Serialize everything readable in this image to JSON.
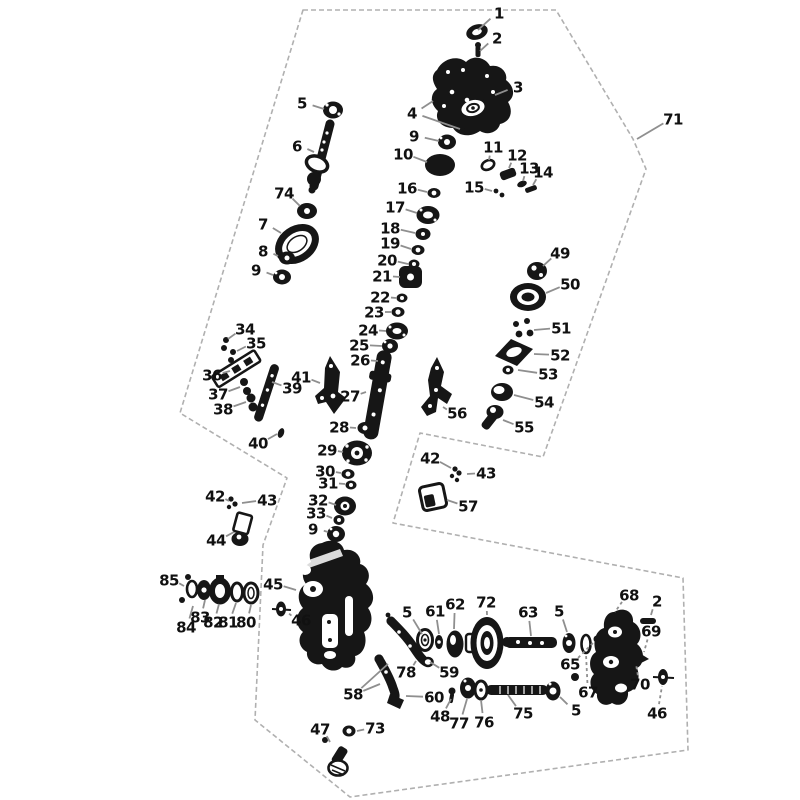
{
  "diagram": {
    "type": "exploded-parts-diagram",
    "title": "Gearbox / transfer case exploded parts diagram",
    "background_color": "#ffffff",
    "ink_color": "#161616",
    "leader_color": "#8f8f8f",
    "outline_color": "#b0b0b0",
    "canvas": {
      "width": 800,
      "height": 800
    },
    "outline_label": "71",
    "outline_points": [
      [
        303,
        10
      ],
      [
        556,
        10
      ],
      [
        633,
        139
      ],
      [
        646,
        169
      ],
      [
        543,
        457
      ],
      [
        420,
        433
      ],
      [
        393,
        523
      ],
      [
        683,
        578
      ],
      [
        688,
        750
      ],
      [
        350,
        797
      ],
      [
        255,
        720
      ],
      [
        263,
        545
      ],
      [
        287,
        478
      ],
      [
        180,
        413
      ]
    ],
    "callouts": [
      {
        "n": "1",
        "x": 499,
        "y": 13,
        "leads": [
          [
            478,
            30
          ]
        ]
      },
      {
        "n": "2",
        "x": 497,
        "y": 38,
        "leads": [
          [
            480,
            51
          ]
        ]
      },
      {
        "n": "3",
        "x": 518,
        "y": 87,
        "leads": [
          [
            495,
            95
          ]
        ]
      },
      {
        "n": "4",
        "x": 412,
        "y": 113,
        "leads": [
          [
            433,
            101
          ],
          [
            460,
            129
          ]
        ]
      },
      {
        "n": "5",
        "x": 302,
        "y": 103,
        "leads": [
          [
            324,
            109
          ]
        ]
      },
      {
        "n": "6",
        "x": 297,
        "y": 146,
        "leads": [
          [
            314,
            152
          ]
        ]
      },
      {
        "n": "9",
        "x": 414,
        "y": 136,
        "leads": [
          [
            439,
            141
          ]
        ]
      },
      {
        "n": "10",
        "x": 403,
        "y": 154,
        "leads": [
          [
            427,
            162
          ]
        ]
      },
      {
        "n": "11",
        "x": 493,
        "y": 147,
        "leads": [
          [
            489,
            160
          ]
        ]
      },
      {
        "n": "12",
        "x": 517,
        "y": 155,
        "leads": [
          [
            509,
            168
          ]
        ]
      },
      {
        "n": "13",
        "x": 529,
        "y": 168,
        "leads": [
          [
            523,
            181
          ]
        ]
      },
      {
        "n": "14",
        "x": 543,
        "y": 172,
        "leads": [
          [
            533,
            185
          ]
        ]
      },
      {
        "n": "15",
        "x": 474,
        "y": 187,
        "leads": [
          [
            492,
            191
          ]
        ]
      },
      {
        "n": "16",
        "x": 407,
        "y": 188,
        "leads": [
          [
            427,
            192
          ]
        ]
      },
      {
        "n": "74",
        "x": 284,
        "y": 193,
        "leads": [
          [
            300,
            206
          ]
        ]
      },
      {
        "n": "7",
        "x": 263,
        "y": 224,
        "leads": [
          [
            281,
            233
          ]
        ]
      },
      {
        "n": "8",
        "x": 263,
        "y": 251,
        "leads": [
          [
            278,
            256
          ]
        ]
      },
      {
        "n": "9",
        "x": 256,
        "y": 270,
        "leads": [
          [
            273,
            275
          ]
        ]
      },
      {
        "n": "17",
        "x": 395,
        "y": 207,
        "leads": [
          [
            417,
            213
          ]
        ]
      },
      {
        "n": "18",
        "x": 390,
        "y": 228,
        "leads": [
          [
            415,
            233
          ]
        ]
      },
      {
        "n": "19",
        "x": 390,
        "y": 243,
        "leads": [
          [
            411,
            249
          ]
        ]
      },
      {
        "n": "20",
        "x": 387,
        "y": 260,
        "leads": [
          [
            408,
            264
          ]
        ]
      },
      {
        "n": "21",
        "x": 382,
        "y": 276,
        "leads": [
          [
            400,
            277
          ]
        ]
      },
      {
        "n": "22",
        "x": 380,
        "y": 297,
        "leads": [
          [
            396,
            298
          ]
        ]
      },
      {
        "n": "23",
        "x": 374,
        "y": 312,
        "leads": [
          [
            391,
            312
          ]
        ]
      },
      {
        "n": "24",
        "x": 368,
        "y": 330,
        "leads": [
          [
            386,
            331
          ]
        ]
      },
      {
        "n": "25",
        "x": 359,
        "y": 345,
        "leads": [
          [
            382,
            346
          ]
        ]
      },
      {
        "n": "26",
        "x": 360,
        "y": 360,
        "leads": [
          [
            378,
            361
          ]
        ]
      },
      {
        "n": "49",
        "x": 560,
        "y": 253,
        "leads": [
          [
            543,
            266
          ]
        ]
      },
      {
        "n": "50",
        "x": 570,
        "y": 284,
        "leads": [
          [
            546,
            293
          ]
        ]
      },
      {
        "n": "51",
        "x": 561,
        "y": 328,
        "leads": [
          [
            534,
            330
          ]
        ]
      },
      {
        "n": "52",
        "x": 560,
        "y": 355,
        "leads": [
          [
            534,
            354
          ]
        ]
      },
      {
        "n": "53",
        "x": 548,
        "y": 374,
        "leads": [
          [
            518,
            370
          ]
        ]
      },
      {
        "n": "54",
        "x": 544,
        "y": 402,
        "leads": [
          [
            514,
            395
          ]
        ]
      },
      {
        "n": "55",
        "x": 524,
        "y": 427,
        "leads": [
          [
            503,
            420
          ]
        ]
      },
      {
        "n": "56",
        "x": 457,
        "y": 413,
        "leads": [
          [
            443,
            407
          ]
        ]
      },
      {
        "n": "34",
        "x": 245,
        "y": 329,
        "leads": [
          [
            228,
            339
          ]
        ]
      },
      {
        "n": "35",
        "x": 256,
        "y": 343,
        "leads": [
          [
            237,
            351
          ]
        ]
      },
      {
        "n": "36",
        "x": 212,
        "y": 375,
        "leads": [
          [
            230,
            371
          ]
        ]
      },
      {
        "n": "37",
        "x": 218,
        "y": 394,
        "leads": [
          [
            240,
            387
          ]
        ]
      },
      {
        "n": "38",
        "x": 223,
        "y": 409,
        "leads": [
          [
            246,
            402
          ]
        ]
      },
      {
        "n": "39",
        "x": 292,
        "y": 388,
        "leads": [
          [
            272,
            382
          ]
        ]
      },
      {
        "n": "40",
        "x": 258,
        "y": 443,
        "leads": [
          [
            277,
            434
          ]
        ]
      },
      {
        "n": "41",
        "x": 301,
        "y": 377,
        "leads": [
          [
            320,
            383
          ]
        ]
      },
      {
        "n": "27",
        "x": 350,
        "y": 396,
        "leads": [
          [
            366,
            392
          ]
        ]
      },
      {
        "n": "28",
        "x": 339,
        "y": 427,
        "leads": [
          [
            356,
            428
          ]
        ]
      },
      {
        "n": "29",
        "x": 327,
        "y": 450,
        "leads": [
          [
            343,
            452
          ]
        ]
      },
      {
        "n": "30",
        "x": 325,
        "y": 471,
        "leads": [
          [
            341,
            473
          ]
        ]
      },
      {
        "n": "31",
        "x": 328,
        "y": 483,
        "leads": [
          [
            345,
            484
          ]
        ]
      },
      {
        "n": "32",
        "x": 318,
        "y": 500,
        "leads": [
          [
            336,
            505
          ]
        ]
      },
      {
        "n": "33",
        "x": 316,
        "y": 513,
        "leads": [
          [
            332,
            518
          ]
        ]
      },
      {
        "n": "9",
        "x": 313,
        "y": 529,
        "leads": [
          [
            328,
            532
          ]
        ]
      },
      {
        "n": "42",
        "x": 215,
        "y": 496,
        "leads": [
          [
            229,
            501
          ]
        ]
      },
      {
        "n": "43",
        "x": 267,
        "y": 500,
        "leads": [
          [
            242,
            503
          ]
        ]
      },
      {
        "n": "44",
        "x": 216,
        "y": 540,
        "leads": [
          [
            234,
            532
          ]
        ]
      },
      {
        "n": "42",
        "x": 430,
        "y": 458,
        "leads": [
          [
            451,
            468
          ]
        ]
      },
      {
        "n": "43",
        "x": 486,
        "y": 473,
        "leads": [
          [
            467,
            474
          ]
        ]
      },
      {
        "n": "57",
        "x": 468,
        "y": 506,
        "leads": [
          [
            447,
            500
          ]
        ]
      },
      {
        "n": "45",
        "x": 273,
        "y": 584,
        "leads": [
          [
            296,
            590
          ]
        ]
      },
      {
        "n": "46",
        "x": 301,
        "y": 620,
        "dash": true,
        "leads": [
          [
            287,
            612
          ]
        ]
      },
      {
        "n": "85",
        "x": 169,
        "y": 580,
        "leads": [
          [
            184,
            586
          ]
        ]
      },
      {
        "n": "83",
        "x": 200,
        "y": 617,
        "leads": [
          [
            205,
            600
          ]
        ]
      },
      {
        "n": "84",
        "x": 186,
        "y": 627,
        "leads": [
          [
            193,
            606
          ]
        ]
      },
      {
        "n": "82",
        "x": 213,
        "y": 622,
        "leads": [
          [
            219,
            604
          ]
        ]
      },
      {
        "n": "81",
        "x": 228,
        "y": 622,
        "leads": [
          [
            236,
            603
          ]
        ]
      },
      {
        "n": "80",
        "x": 246,
        "y": 622,
        "leads": [
          [
            251,
            605
          ]
        ]
      },
      {
        "n": "58",
        "x": 353,
        "y": 694,
        "leads": [
          [
            388,
            664
          ],
          [
            380,
            684
          ]
        ]
      },
      {
        "n": "78",
        "x": 406,
        "y": 672,
        "leads": [
          [
            416,
            661
          ]
        ]
      },
      {
        "n": "59",
        "x": 449,
        "y": 672,
        "leads": [
          [
            430,
            662
          ]
        ]
      },
      {
        "n": "60",
        "x": 434,
        "y": 697,
        "leads": [
          [
            406,
            696
          ]
        ]
      },
      {
        "n": "48",
        "x": 440,
        "y": 716,
        "leads": [
          [
            451,
            699
          ]
        ]
      },
      {
        "n": "77",
        "x": 459,
        "y": 723,
        "leads": [
          [
            467,
            699
          ]
        ]
      },
      {
        "n": "76",
        "x": 484,
        "y": 722,
        "leads": [
          [
            481,
            700
          ]
        ]
      },
      {
        "n": "75",
        "x": 523,
        "y": 713,
        "leads": [
          [
            508,
            695
          ]
        ]
      },
      {
        "n": "5",
        "x": 576,
        "y": 710,
        "leads": [
          [
            560,
            697
          ]
        ]
      },
      {
        "n": "5",
        "x": 407,
        "y": 612,
        "leads": [
          [
            422,
            634
          ]
        ]
      },
      {
        "n": "61",
        "x": 435,
        "y": 611,
        "leads": [
          [
            439,
            634
          ]
        ]
      },
      {
        "n": "62",
        "x": 455,
        "y": 604,
        "leads": [
          [
            454,
            629
          ]
        ]
      },
      {
        "n": "72",
        "x": 486,
        "y": 602,
        "leads": [
          [
            487,
            615
          ]
        ]
      },
      {
        "n": "63",
        "x": 528,
        "y": 612,
        "leads": [
          [
            531,
            636
          ]
        ]
      },
      {
        "n": "5",
        "x": 559,
        "y": 611,
        "leads": [
          [
            567,
            632
          ]
        ]
      },
      {
        "n": "65",
        "x": 570,
        "y": 664,
        "dash": true,
        "leads": [
          [
            594,
            642
          ]
        ]
      },
      {
        "n": "67",
        "x": 588,
        "y": 692,
        "dash": true,
        "leads": [
          [
            586,
            654
          ]
        ]
      },
      {
        "n": "68",
        "x": 629,
        "y": 595,
        "dash": true,
        "leads": [
          [
            615,
            612
          ]
        ]
      },
      {
        "n": "2",
        "x": 657,
        "y": 601,
        "leads": [
          [
            651,
            615
          ]
        ]
      },
      {
        "n": "69",
        "x": 651,
        "y": 631,
        "dash": true,
        "leads": [
          [
            644,
            652
          ]
        ]
      },
      {
        "n": "70",
        "x": 640,
        "y": 684,
        "dash": true,
        "leads": [
          [
            636,
            664
          ]
        ]
      },
      {
        "n": "46",
        "x": 657,
        "y": 713,
        "dash": true,
        "leads": [
          [
            662,
            686
          ]
        ]
      },
      {
        "n": "47",
        "x": 320,
        "y": 729,
        "leads": [
          [
            330,
            742
          ]
        ]
      },
      {
        "n": "73",
        "x": 375,
        "y": 728,
        "leads": [
          [
            357,
            731
          ]
        ]
      },
      {
        "n": "71",
        "x": 673,
        "y": 119,
        "leads": [
          [
            637,
            139
          ]
        ]
      }
    ]
  }
}
